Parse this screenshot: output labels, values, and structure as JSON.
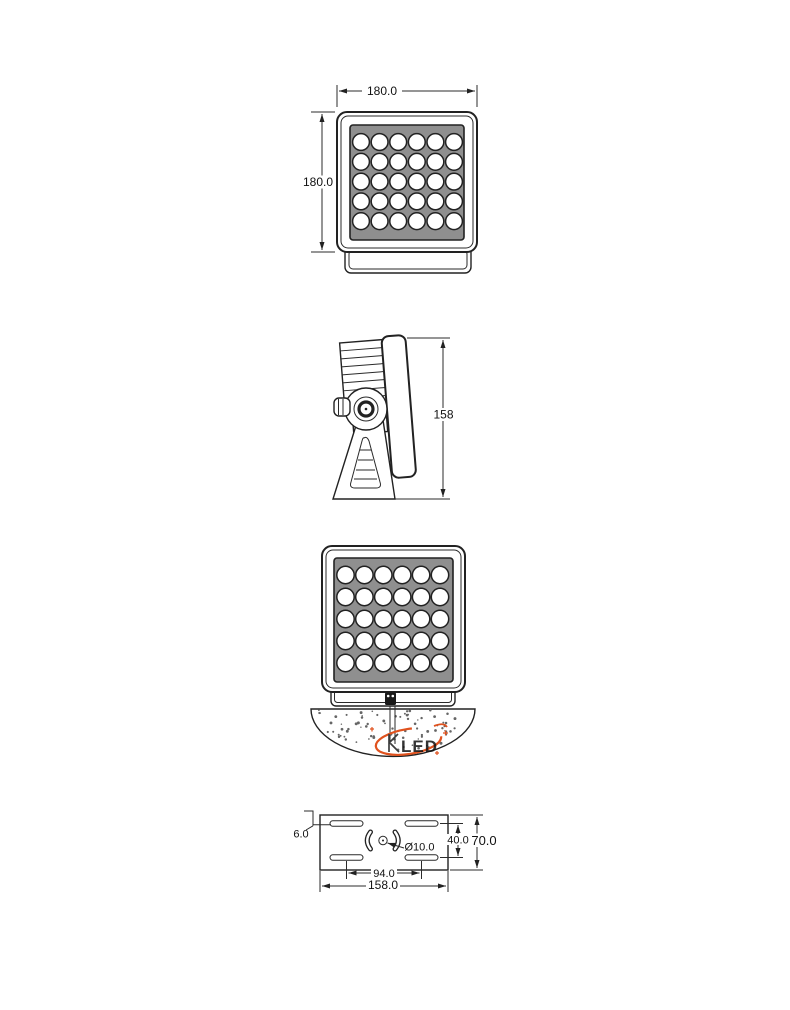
{
  "drawing": {
    "views": {
      "front": {
        "width_dim": "180.0",
        "height_dim": "180.0"
      },
      "side": {
        "depth_dim": "158"
      },
      "installed": {
        "watermark": "LED"
      },
      "plate": {
        "slot_width_dim": "6.0",
        "hole_dim": "Ø10.0",
        "slot_span_dim": "40.0",
        "height_dim": "70.0",
        "slot_pitch_dim": "94.0",
        "width_dim": "158.0"
      }
    },
    "led_grid": {
      "columns": 6,
      "rows": 5
    }
  },
  "colors": {
    "line": "#222222",
    "panel": "#8f8f8f",
    "logo_orange": "#e0521e",
    "watermark_text": "#4a4a4a"
  }
}
